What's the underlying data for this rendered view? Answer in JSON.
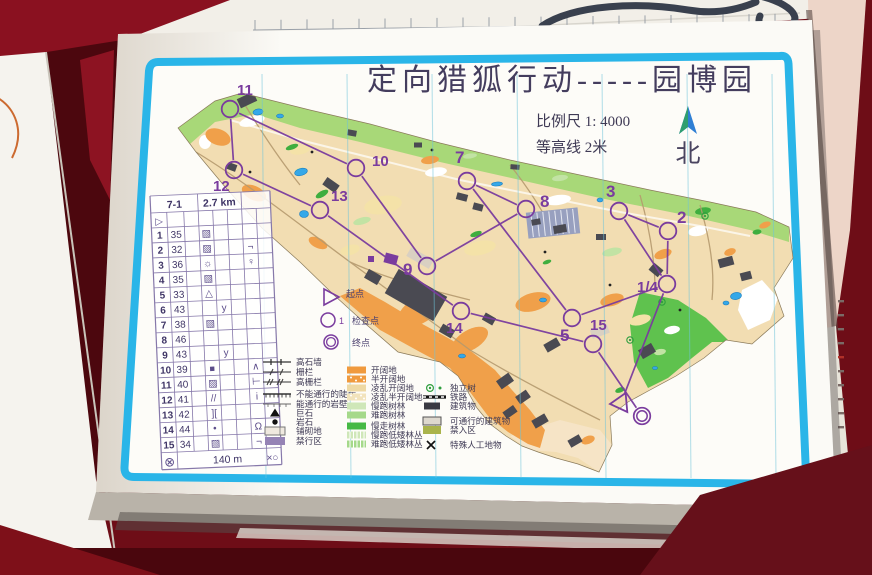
{
  "photo": {
    "table_color": "#6e0d17",
    "accent_border_color": "#2ab5e8",
    "course_color": "#7a3c9e"
  },
  "sheet": {
    "title": "定向猎狐行动-----园博园",
    "scale_label": "比例尺 1: 4000",
    "contour_label": "等高线 2米",
    "north_label": "北"
  },
  "control_card": {
    "course": "7-1",
    "length": "2.7 km",
    "start_symbol": "▷",
    "footer_left_symbol": "⊗",
    "footer_distance": "140 m",
    "footer_right_symbol": "×○",
    "rows": [
      {
        "no": "1",
        "code": "35",
        "d": "▨",
        "e": "",
        "g": ""
      },
      {
        "no": "2",
        "code": "32",
        "d": "▨",
        "e": "",
        "g": "¬"
      },
      {
        "no": "3",
        "code": "36",
        "d": "☼",
        "e": "",
        "g": "♀"
      },
      {
        "no": "4",
        "code": "35",
        "d": "▨",
        "e": "",
        "g": ""
      },
      {
        "no": "5",
        "code": "33",
        "d": "△",
        "e": "",
        "g": ""
      },
      {
        "no": "6",
        "code": "43",
        "d": "",
        "e": "y",
        "g": ""
      },
      {
        "no": "7",
        "code": "38",
        "d": "▨",
        "e": "",
        "g": ""
      },
      {
        "no": "8",
        "code": "46",
        "d": "",
        "e": "",
        "g": ""
      },
      {
        "no": "9",
        "code": "43",
        "d": "",
        "e": "y",
        "g": ""
      },
      {
        "no": "10",
        "code": "39",
        "d": "■",
        "e": "",
        "g": "∧"
      },
      {
        "no": "11",
        "code": "40",
        "d": "▨",
        "e": "",
        "g": "⊢"
      },
      {
        "no": "12",
        "code": "41",
        "d": "//",
        "e": "",
        "g": "i"
      },
      {
        "no": "13",
        "code": "42",
        "d": "][",
        "e": "",
        "g": ""
      },
      {
        "no": "14",
        "code": "44",
        "d": "•",
        "e": "",
        "g": "Ω"
      },
      {
        "no": "15",
        "code": "34",
        "d": "▨",
        "e": "",
        "g": "¬"
      }
    ]
  },
  "course_legend": {
    "start": "起点",
    "checkpoint_number": "1",
    "checkpoint": "检查点",
    "finish": "终点"
  },
  "legend": {
    "line_features": [
      {
        "label": "高石墙",
        "type": "stone-wall"
      },
      {
        "label": "栅栏",
        "type": "fence"
      },
      {
        "label": "高栅栏",
        "type": "high-fence"
      },
      {
        "label": "不能通行的陡崖",
        "type": "cliff"
      },
      {
        "label": "能通行的岩壁",
        "type": "rock-face"
      },
      {
        "label": "巨石",
        "type": "boulder"
      },
      {
        "label": "岩石",
        "type": "rock"
      },
      {
        "label": "铺砌地",
        "type": "paved"
      },
      {
        "label": "禁行区",
        "type": "oob"
      }
    ],
    "area_features": [
      {
        "label": "开阔地",
        "color": "#f09a3e",
        "pattern": "solid"
      },
      {
        "label": "半开阔地",
        "color": "#f09a3e",
        "pattern": "dots"
      },
      {
        "label": "凌乱开阔地",
        "color": "#eed9a4",
        "pattern": "solid"
      },
      {
        "label": "凌乱半开阔地",
        "color": "#f2e3bc",
        "pattern": "dots"
      },
      {
        "label": "慢跑树林",
        "color": "#cfe7b8",
        "pattern": "solid"
      },
      {
        "label": "难跑树林",
        "color": "#a5d98a",
        "pattern": "solid"
      },
      {
        "label": "慢走树林",
        "color": "#46b945",
        "pattern": "solid"
      },
      {
        "label": "慢跑低矮林丛",
        "color": "#cfe7b8",
        "pattern": "stripes"
      },
      {
        "label": "难跑低矮林丛",
        "color": "#a5d98a",
        "pattern": "stripes"
      }
    ],
    "point_features": [
      {
        "label": "独立树",
        "type": "tree"
      },
      {
        "label": "铁路",
        "type": "railway"
      },
      {
        "label": "建筑物",
        "type": "building"
      },
      {
        "label": "可通行的建筑物",
        "type": "passable-building"
      },
      {
        "label": "禁入区",
        "type": "forbidden",
        "color": "#a9b34b"
      },
      {
        "label": "特殊人工地物",
        "type": "special"
      }
    ]
  },
  "course": {
    "color": "#7a3c9e",
    "controls": [
      {
        "id": "11",
        "cx": 230,
        "cy": 109,
        "lx": 237,
        "ly": 95
      },
      {
        "id": "12",
        "cx": 234,
        "cy": 170,
        "lx": 213,
        "ly": 191
      },
      {
        "id": "10",
        "cx": 356,
        "cy": 168,
        "lx": 372,
        "ly": 166
      },
      {
        "id": "13",
        "cx": 320,
        "cy": 210,
        "lx": 331,
        "ly": 201
      },
      {
        "id": "7",
        "cx": 467,
        "cy": 181,
        "lx": 455,
        "ly": 163
      },
      {
        "id": "8",
        "cx": 526,
        "cy": 209,
        "lx": 540,
        "ly": 207
      },
      {
        "id": "3",
        "cx": 619,
        "cy": 211,
        "lx": 606,
        "ly": 197
      },
      {
        "id": "2",
        "cx": 668,
        "cy": 231,
        "lx": 677,
        "ly": 223
      },
      {
        "id": "1/4",
        "cx": 667,
        "cy": 284,
        "lx": 637,
        "ly": 292
      },
      {
        "id": "9",
        "cx": 427,
        "cy": 266,
        "lx": 403,
        "ly": 275
      },
      {
        "id": "14",
        "cx": 461,
        "cy": 311,
        "lx": 446,
        "ly": 333
      },
      {
        "id": "5",
        "cx": 572,
        "cy": 318,
        "lx": 560,
        "ly": 341
      },
      {
        "id": "15",
        "cx": 593,
        "cy": 344,
        "lx": 590,
        "ly": 330
      }
    ],
    "start": {
      "x": 621,
      "y": 403
    },
    "finish": {
      "cx": 642,
      "cy": 416
    },
    "legs": [
      [
        "S",
        "1/4"
      ],
      [
        "1/4",
        "2"
      ],
      [
        "2",
        "3"
      ],
      [
        "3",
        "1/4"
      ],
      [
        "1/4",
        "5"
      ],
      [
        "5",
        "7"
      ],
      [
        "7",
        "8"
      ],
      [
        "8",
        "9"
      ],
      [
        "9",
        "10"
      ],
      [
        "10",
        "11"
      ],
      [
        "11",
        "12"
      ],
      [
        "12",
        "13"
      ],
      [
        "13",
        "14"
      ],
      [
        "14",
        "15"
      ],
      [
        "15",
        "F"
      ]
    ]
  },
  "map": {
    "north_line_xs": [
      262,
      347,
      432,
      517,
      602,
      687,
      772
    ],
    "north_line_color": "#6fc4da"
  }
}
